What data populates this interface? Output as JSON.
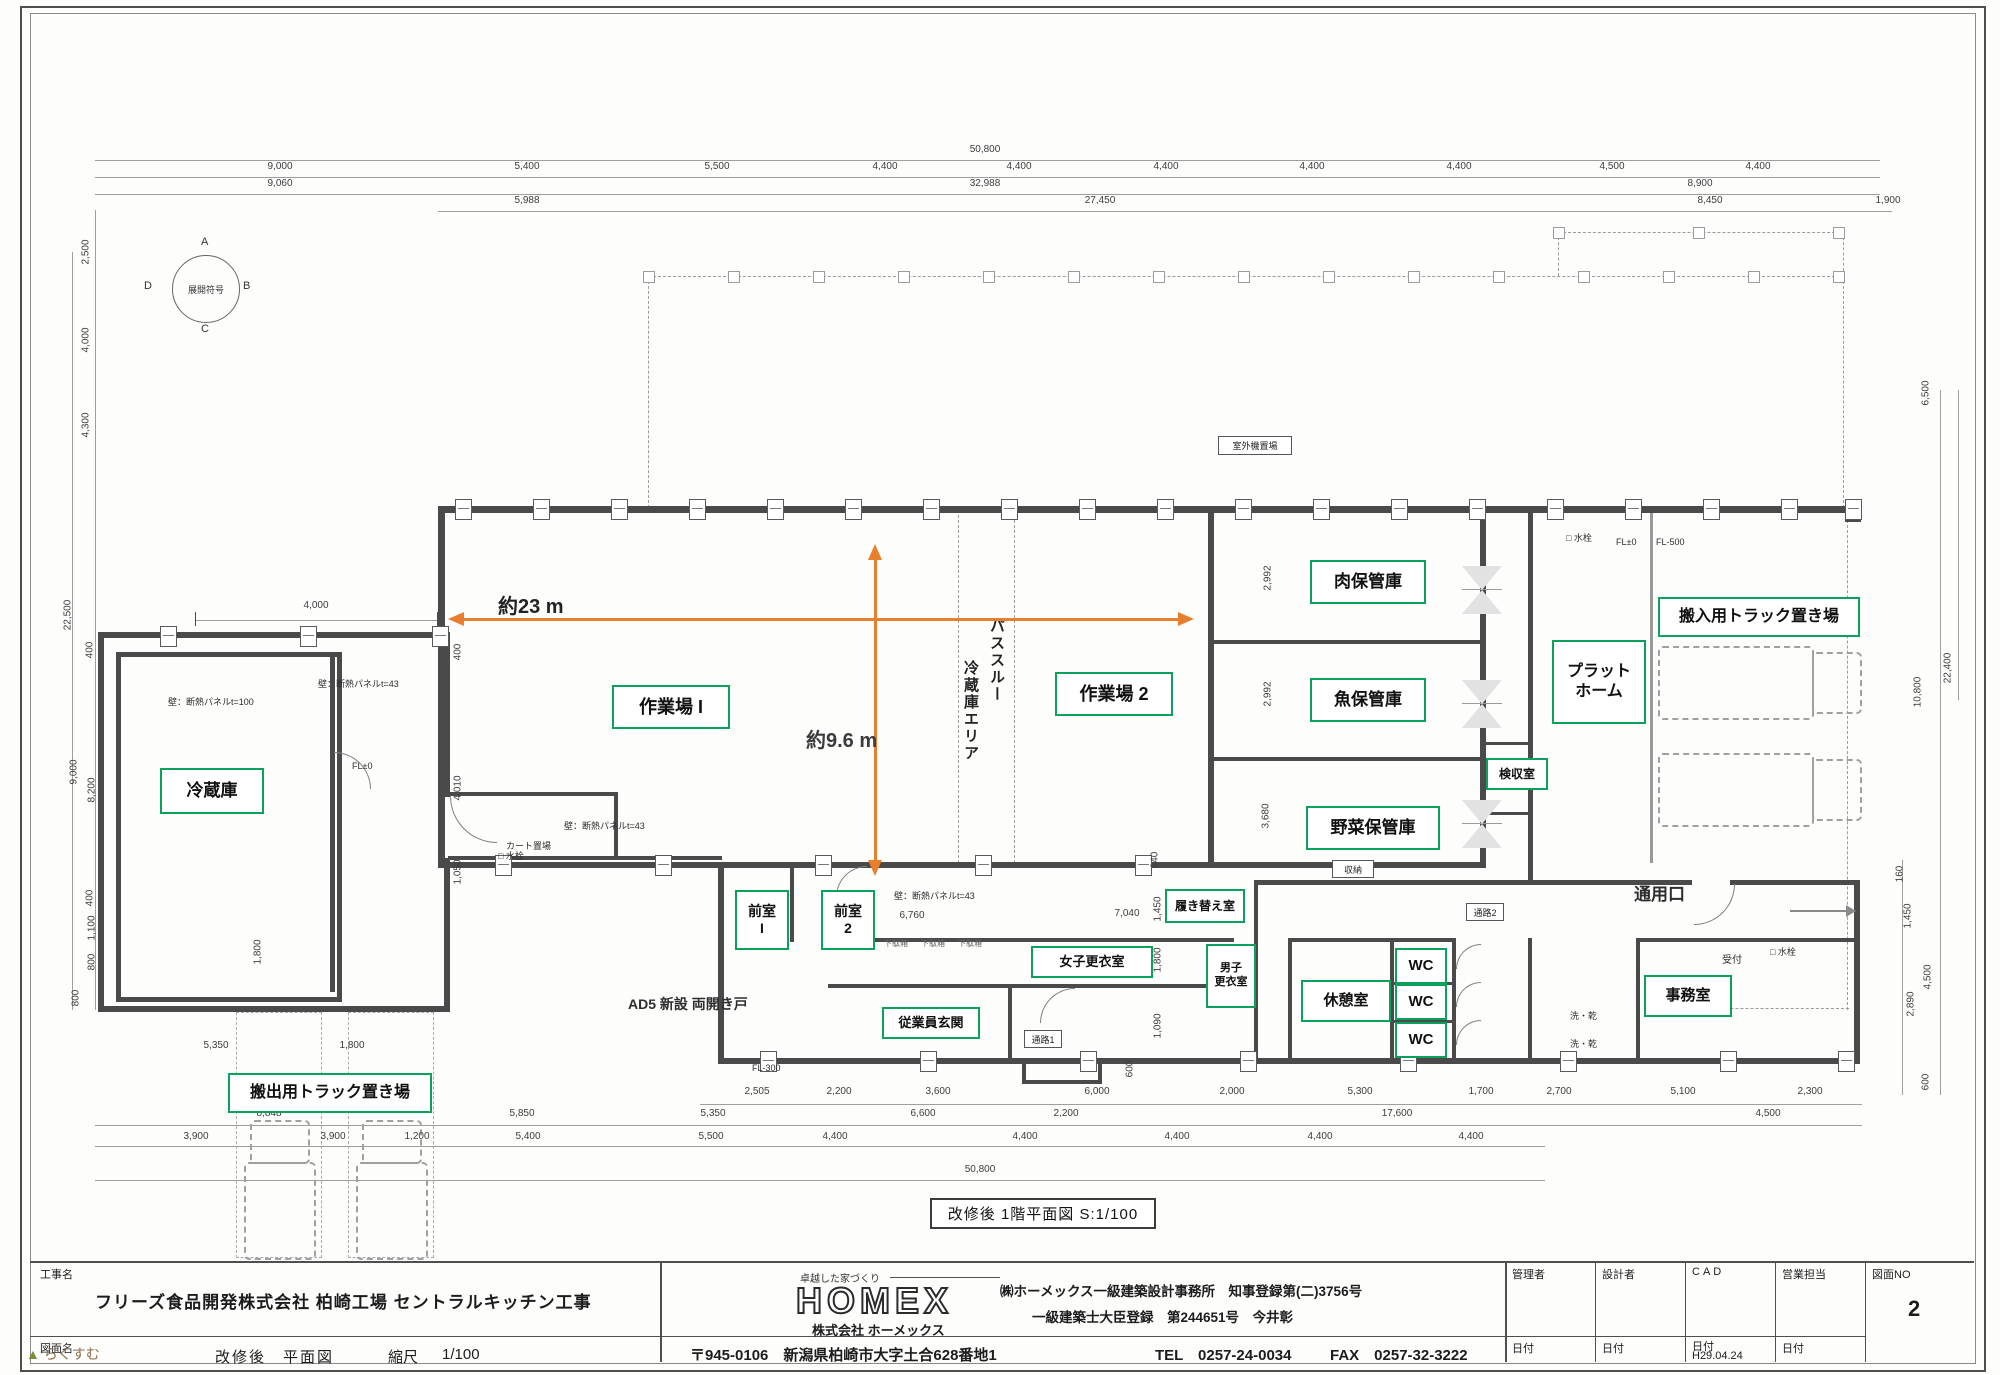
{
  "colors": {
    "green": "#0ca05e",
    "orange": "#e87f2e",
    "wall": "#4a4a4a"
  },
  "compass": {
    "label": "展開符号",
    "n": "A",
    "e": "B",
    "s": "C",
    "w": "D"
  },
  "measure": {
    "h_label": "約23 m",
    "v_label": "約9.6 m"
  },
  "pass_through": {
    "col1": "パススルー",
    "col2": "冷蔵庫エリア"
  },
  "caption": "改修後  1階平面図  S:1/100",
  "watermark": "らくすむ",
  "rooms": [
    {
      "label": "冷蔵庫",
      "x": 160,
      "y": 768,
      "w": 100,
      "h": 42,
      "fs": 17
    },
    {
      "label": "作業場 I",
      "x": 612,
      "y": 685,
      "w": 114,
      "h": 40,
      "fs": 18
    },
    {
      "label": "作業場 2",
      "x": 1055,
      "y": 672,
      "w": 114,
      "h": 40,
      "fs": 18
    },
    {
      "label": "肉保管庫",
      "x": 1310,
      "y": 560,
      "w": 112,
      "h": 40,
      "fs": 17
    },
    {
      "label": "魚保管庫",
      "x": 1310,
      "y": 678,
      "w": 112,
      "h": 40,
      "fs": 17
    },
    {
      "label": "野菜保管庫",
      "x": 1306,
      "y": 806,
      "w": 130,
      "h": 40,
      "fs": 17
    },
    {
      "label": "検収室",
      "x": 1486,
      "y": 758,
      "w": 58,
      "h": 28,
      "fs": 12
    },
    {
      "label": "プラット\nホーム",
      "x": 1552,
      "y": 640,
      "w": 90,
      "h": 80,
      "fs": 16
    },
    {
      "label": "搬入用トラック置き場",
      "x": 1658,
      "y": 597,
      "w": 198,
      "h": 36,
      "fs": 16
    },
    {
      "label": "搬出用トラック置き場",
      "x": 228,
      "y": 1073,
      "w": 200,
      "h": 36,
      "fs": 16
    },
    {
      "label": "前室\nI",
      "x": 735,
      "y": 890,
      "w": 50,
      "h": 56,
      "fs": 14
    },
    {
      "label": "前室\n2",
      "x": 821,
      "y": 890,
      "w": 50,
      "h": 56,
      "fs": 14
    },
    {
      "label": "従業員玄関",
      "x": 882,
      "y": 1007,
      "w": 94,
      "h": 28,
      "fs": 13
    },
    {
      "label": "女子更衣室",
      "x": 1031,
      "y": 946,
      "w": 118,
      "h": 28,
      "fs": 13
    },
    {
      "label": "履き替え室",
      "x": 1165,
      "y": 889,
      "w": 76,
      "h": 30,
      "fs": 12
    },
    {
      "label": "男子\n更衣室",
      "x": 1206,
      "y": 944,
      "w": 46,
      "h": 60,
      "fs": 11
    },
    {
      "label": "休憩室",
      "x": 1301,
      "y": 980,
      "w": 86,
      "h": 38,
      "fs": 15
    },
    {
      "label": "WC",
      "x": 1395,
      "y": 948,
      "w": 48,
      "h": 32,
      "fs": 15
    },
    {
      "label": "WC",
      "x": 1395,
      "y": 984,
      "w": 48,
      "h": 32,
      "fs": 15
    },
    {
      "label": "WC",
      "x": 1395,
      "y": 1022,
      "w": 48,
      "h": 32,
      "fs": 15
    },
    {
      "label": "事務室",
      "x": 1644,
      "y": 975,
      "w": 84,
      "h": 38,
      "fs": 15
    }
  ],
  "boxed_labels": [
    {
      "text": "収納",
      "x": 1332,
      "y": 860,
      "w": 40,
      "h": 16,
      "fs": 9
    },
    {
      "text": "通路1",
      "x": 1024,
      "y": 1030,
      "w": 36,
      "h": 16,
      "fs": 9
    },
    {
      "text": "通路2",
      "x": 1466,
      "y": 903,
      "w": 36,
      "h": 16,
      "fs": 9
    },
    {
      "text": "室外機置場",
      "x": 1218,
      "y": 436,
      "w": 72,
      "h": 17,
      "fs": 9
    }
  ],
  "labels": [
    {
      "text": "通用口",
      "x": 1634,
      "y": 886,
      "fs": 17,
      "b": 1
    },
    {
      "text": "AD5 新設 両開き戸",
      "x": 628,
      "y": 997,
      "fs": 14,
      "b": 1
    },
    {
      "text": "受付",
      "x": 1722,
      "y": 955,
      "fs": 10
    },
    {
      "text": "FL±0",
      "x": 352,
      "y": 762,
      "fs": 9
    },
    {
      "text": "FL±0",
      "x": 1616,
      "y": 538,
      "fs": 9
    },
    {
      "text": "FL-500",
      "x": 1656,
      "y": 538,
      "fs": 9
    },
    {
      "text": "FL-300",
      "x": 752,
      "y": 1064,
      "fs": 9
    },
    {
      "text": "□ 水栓",
      "x": 1566,
      "y": 534,
      "fs": 9
    },
    {
      "text": "□ 水栓",
      "x": 1770,
      "y": 948,
      "fs": 9
    },
    {
      "text": "□ 水栓",
      "x": 498,
      "y": 852,
      "fs": 9
    },
    {
      "text": "カート置場",
      "x": 506,
      "y": 842,
      "fs": 9
    },
    {
      "text": "壁：断熱パネルt=100",
      "x": 168,
      "y": 698,
      "fs": 9
    },
    {
      "text": "壁：断熱パネルt=43",
      "x": 318,
      "y": 680,
      "fs": 9
    },
    {
      "text": "壁：断熱パネルt=43",
      "x": 564,
      "y": 822,
      "fs": 9
    },
    {
      "text": "壁：断熱パネルt=43",
      "x": 894,
      "y": 892,
      "fs": 9
    },
    {
      "text": "下駄箱",
      "x": 884,
      "y": 940,
      "fs": 8,
      "c": "#666"
    },
    {
      "text": "下駄箱",
      "x": 921,
      "y": 940,
      "fs": 8,
      "c": "#666"
    },
    {
      "text": "下駄箱",
      "x": 958,
      "y": 940,
      "fs": 8,
      "c": "#666"
    },
    {
      "text": "洗・乾",
      "x": 1570,
      "y": 1012,
      "fs": 9
    },
    {
      "text": "洗・乾",
      "x": 1570,
      "y": 1040,
      "fs": 9
    }
  ],
  "dims": [
    {
      "t": "50,800",
      "x": 985,
      "y": 150
    },
    {
      "t": "9,000",
      "x": 280,
      "y": 167
    },
    {
      "t": "5,400",
      "x": 527,
      "y": 167
    },
    {
      "t": "5,500",
      "x": 717,
      "y": 167
    },
    {
      "t": "4,400",
      "x": 885,
      "y": 167
    },
    {
      "t": "4,400",
      "x": 1019,
      "y": 167
    },
    {
      "t": "4,400",
      "x": 1166,
      "y": 167
    },
    {
      "t": "4,400",
      "x": 1312,
      "y": 167
    },
    {
      "t": "4,400",
      "x": 1459,
      "y": 167
    },
    {
      "t": "4,500",
      "x": 1612,
      "y": 167
    },
    {
      "t": "4,400",
      "x": 1758,
      "y": 167
    },
    {
      "t": "9,060",
      "x": 280,
      "y": 184
    },
    {
      "t": "32,988",
      "x": 985,
      "y": 184
    },
    {
      "t": "8,900",
      "x": 1700,
      "y": 184
    },
    {
      "t": "5,988",
      "x": 527,
      "y": 201
    },
    {
      "t": "27,450",
      "x": 1100,
      "y": 201
    },
    {
      "t": "8,450",
      "x": 1710,
      "y": 201
    },
    {
      "t": "1,900",
      "x": 1888,
      "y": 201
    },
    {
      "t": "2,505",
      "x": 757,
      "y": 1092
    },
    {
      "t": "2,200",
      "x": 839,
      "y": 1092
    },
    {
      "t": "3,600",
      "x": 938,
      "y": 1092
    },
    {
      "t": "6,000",
      "x": 1097,
      "y": 1092
    },
    {
      "t": "2,000",
      "x": 1232,
      "y": 1092
    },
    {
      "t": "5,300",
      "x": 1360,
      "y": 1092
    },
    {
      "t": "1,700",
      "x": 1481,
      "y": 1092
    },
    {
      "t": "2,700",
      "x": 1559,
      "y": 1092
    },
    {
      "t": "5,100",
      "x": 1683,
      "y": 1092
    },
    {
      "t": "2,300",
      "x": 1810,
      "y": 1092
    },
    {
      "t": "8,848",
      "x": 269,
      "y": 1114
    },
    {
      "t": "5,850",
      "x": 522,
      "y": 1114
    },
    {
      "t": "5,350",
      "x": 713,
      "y": 1114
    },
    {
      "t": "6,600",
      "x": 923,
      "y": 1114
    },
    {
      "t": "2,200",
      "x": 1066,
      "y": 1114
    },
    {
      "t": "17,600",
      "x": 1397,
      "y": 1114
    },
    {
      "t": "4,500",
      "x": 1768,
      "y": 1114
    },
    {
      "t": "3,900",
      "x": 196,
      "y": 1137
    },
    {
      "t": "3,900",
      "x": 333,
      "y": 1137
    },
    {
      "t": "1,200",
      "x": 417,
      "y": 1137
    },
    {
      "t": "5,400",
      "x": 528,
      "y": 1137
    },
    {
      "t": "5,500",
      "x": 711,
      "y": 1137
    },
    {
      "t": "4,400",
      "x": 835,
      "y": 1137
    },
    {
      "t": "4,400",
      "x": 1025,
      "y": 1137
    },
    {
      "t": "4,400",
      "x": 1177,
      "y": 1137
    },
    {
      "t": "4,400",
      "x": 1320,
      "y": 1137
    },
    {
      "t": "4,400",
      "x": 1471,
      "y": 1137
    },
    {
      "t": "50,800",
      "x": 980,
      "y": 1170
    },
    {
      "t": "5,350",
      "x": 216,
      "y": 1046
    },
    {
      "t": "1,800",
      "x": 352,
      "y": 1046
    },
    {
      "t": "2,500",
      "x": 86,
      "y": 252,
      "r": 1
    },
    {
      "t": "4,000",
      "x": 86,
      "y": 340,
      "r": 1
    },
    {
      "t": "4,300",
      "x": 86,
      "y": 425,
      "r": 1
    },
    {
      "t": "22,500",
      "x": 68,
      "y": 615,
      "r": 1
    },
    {
      "t": "400",
      "x": 90,
      "y": 650,
      "r": 1
    },
    {
      "t": "9,000",
      "x": 74,
      "y": 772,
      "r": 1
    },
    {
      "t": "8,200",
      "x": 92,
      "y": 790,
      "r": 1
    },
    {
      "t": "400",
      "x": 90,
      "y": 898,
      "r": 1
    },
    {
      "t": "1,100",
      "x": 92,
      "y": 928,
      "r": 1
    },
    {
      "t": "800",
      "x": 92,
      "y": 962,
      "r": 1
    },
    {
      "t": "800",
      "x": 76,
      "y": 998,
      "r": 1
    },
    {
      "t": "1,800",
      "x": 258,
      "y": 952,
      "r": 1
    },
    {
      "t": "4,000",
      "x": 316,
      "y": 606
    },
    {
      "t": "400",
      "x": 458,
      "y": 652,
      "r": 1
    },
    {
      "t": "4,010",
      "x": 458,
      "y": 788,
      "r": 1
    },
    {
      "t": "1,050",
      "x": 458,
      "y": 872,
      "r": 1
    },
    {
      "t": "6,500",
      "x": 1926,
      "y": 393,
      "r": 1
    },
    {
      "t": "22,400",
      "x": 1948,
      "y": 668,
      "r": 1
    },
    {
      "t": "10,800",
      "x": 1918,
      "y": 692,
      "r": 1
    },
    {
      "t": "160",
      "x": 1900,
      "y": 874,
      "r": 1
    },
    {
      "t": "1,450",
      "x": 1908,
      "y": 916,
      "r": 1
    },
    {
      "t": "4,500",
      "x": 1928,
      "y": 977,
      "r": 1
    },
    {
      "t": "2,890",
      "x": 1911,
      "y": 1004,
      "r": 1
    },
    {
      "t": "600",
      "x": 1926,
      "y": 1082,
      "r": 1
    },
    {
      "t": "2,992",
      "x": 1268,
      "y": 578,
      "r": 1
    },
    {
      "t": "2,992",
      "x": 1268,
      "y": 694,
      "r": 1
    },
    {
      "t": "3,680",
      "x": 1266,
      "y": 816,
      "r": 1
    },
    {
      "t": "640",
      "x": 1155,
      "y": 860,
      "r": 1
    },
    {
      "t": "1,450",
      "x": 1158,
      "y": 909,
      "r": 1
    },
    {
      "t": "1,800",
      "x": 1158,
      "y": 960,
      "r": 1
    },
    {
      "t": "1,090",
      "x": 1158,
      "y": 1026,
      "r": 1
    },
    {
      "t": "600",
      "x": 1130,
      "y": 1069,
      "r": 1
    },
    {
      "t": "6,760",
      "x": 912,
      "y": 916
    },
    {
      "t": "7,040",
      "x": 1127,
      "y": 914
    }
  ],
  "titleblock": {
    "project_label": "工事名",
    "project_name": "フリーズ食品開発株式会社  柏崎工場  セントラルキッチン工事",
    "drawing_label": "図面名",
    "drawing_name": "改修後　平面図",
    "scale_label": "縮尺",
    "scale_value": "1/100",
    "slogan": "卓越した家づくり",
    "logo": "HOMEX",
    "company": "株式会社 ホーメックス",
    "registration1": "㈱ホーメックス一級建築設計事務所　知事登録第(二)3756号",
    "registration2": "一級建築士大臣登録　第244651号　今井彰",
    "address": "〒945-0106　新潟県柏崎市大字土合628番地1",
    "tel": "TEL　0257-24-0034",
    "fax": "FAX　0257-32-3222",
    "cols": [
      {
        "role": "管理者",
        "date_label": "日付",
        "date_value": ""
      },
      {
        "role": "設計者",
        "date_label": "日付",
        "date_value": ""
      },
      {
        "role": "CAD",
        "date_label": "日付",
        "date_value": "H29.04.24"
      },
      {
        "role": "営業担当",
        "date_label": "日付",
        "date_value": ""
      }
    ],
    "sheet_no_label": "図面NO",
    "sheet_no": "2"
  }
}
